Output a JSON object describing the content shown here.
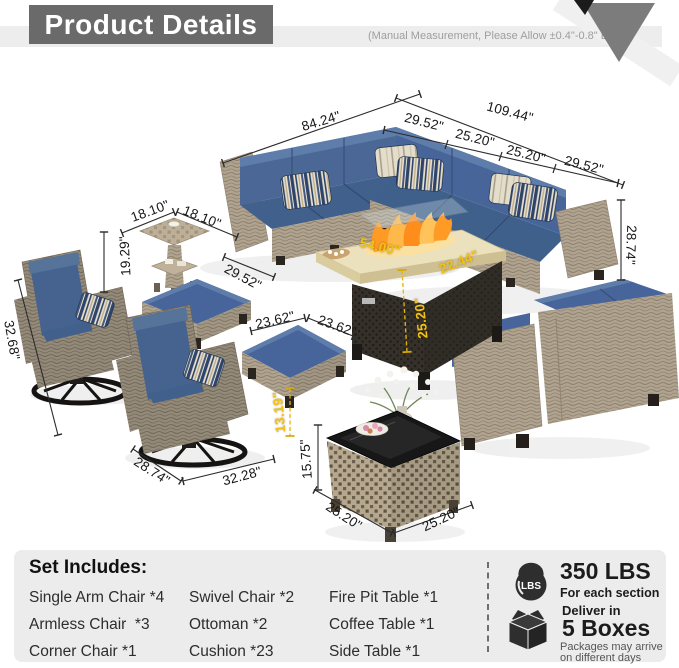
{
  "header": {
    "title": "Product Details",
    "note": "(Manual Measurement, Please Allow ±0.4\"-0.8\" Error.)"
  },
  "colors": {
    "accent_yellow": "#f2c115",
    "cushion_blue": "#46628f",
    "header_gray": "#6a6a6a",
    "panel_gray": "#ececec",
    "icon_dark": "#2e2e2e"
  },
  "diagram": {
    "labels": [
      {
        "text": "109.44\"",
        "x": 510,
        "y": 112,
        "r": 15
      },
      {
        "text": "84.24\"",
        "x": 321,
        "y": 121,
        "r": -17
      },
      {
        "text": "29.52\"",
        "x": 424,
        "y": 122,
        "r": 14
      },
      {
        "text": "25.20\"",
        "x": 475,
        "y": 138,
        "r": 14
      },
      {
        "text": "25.20\"",
        "x": 526,
        "y": 154,
        "r": 14
      },
      {
        "text": "29.52\"",
        "x": 584,
        "y": 165,
        "r": 14
      },
      {
        "text": "18.10\"",
        "x": 150,
        "y": 211,
        "r": -20
      },
      {
        "text": "18.10\"",
        "x": 202,
        "y": 217,
        "r": 22
      },
      {
        "text": "19.29\"",
        "x": 125,
        "y": 256,
        "r": -93
      },
      {
        "text": "29.52\"",
        "x": 243,
        "y": 277,
        "r": 28
      },
      {
        "text": "32.68\"",
        "x": 12,
        "y": 340,
        "r": 80
      },
      {
        "text": "23.62\"",
        "x": 275,
        "y": 320,
        "r": -13
      },
      {
        "text": "23.62\"",
        "x": 337,
        "y": 326,
        "r": 20
      },
      {
        "text": "54.00\"",
        "x": 380,
        "y": 247,
        "r": 13,
        "c": "y"
      },
      {
        "text": "22.44\"",
        "x": 459,
        "y": 262,
        "r": -22,
        "c": "y"
      },
      {
        "text": "25.20\"",
        "x": 421,
        "y": 318,
        "r": -96,
        "c": "y"
      },
      {
        "text": "13.19\"",
        "x": 279,
        "y": 412,
        "r": -95,
        "c": "y"
      },
      {
        "text": "15.75\"",
        "x": 306,
        "y": 459,
        "r": -94
      },
      {
        "text": "28.74\"",
        "x": 152,
        "y": 471,
        "r": 33
      },
      {
        "text": "32.28\"",
        "x": 242,
        "y": 476,
        "r": -15
      },
      {
        "text": "25.20\"",
        "x": 344,
        "y": 516,
        "r": 33
      },
      {
        "text": "25.20\"",
        "x": 441,
        "y": 519,
        "r": -25
      },
      {
        "text": "28.74\"",
        "x": 631,
        "y": 245,
        "r": 92
      }
    ]
  },
  "set_includes": {
    "title": "Set Includes:",
    "columns": [
      [
        "Single Arm Chair *4",
        "Armless Chair  *3",
        "Corner Chair *1"
      ],
      [
        "Swivel Chair *2",
        "Ottoman *2",
        "Cushion *23"
      ],
      [
        "Fire Pit Table *1",
        "Coffee Table *1",
        "Side Table *1"
      ]
    ]
  },
  "shipping": {
    "lbs_badge": "LBS",
    "weight": "350 LBS",
    "weight_note": "For each section",
    "deliver_label": "Deliver in",
    "boxes": "5 Boxes",
    "boxes_note_1": "Packages may arrive",
    "boxes_note_2": "on different days"
  }
}
